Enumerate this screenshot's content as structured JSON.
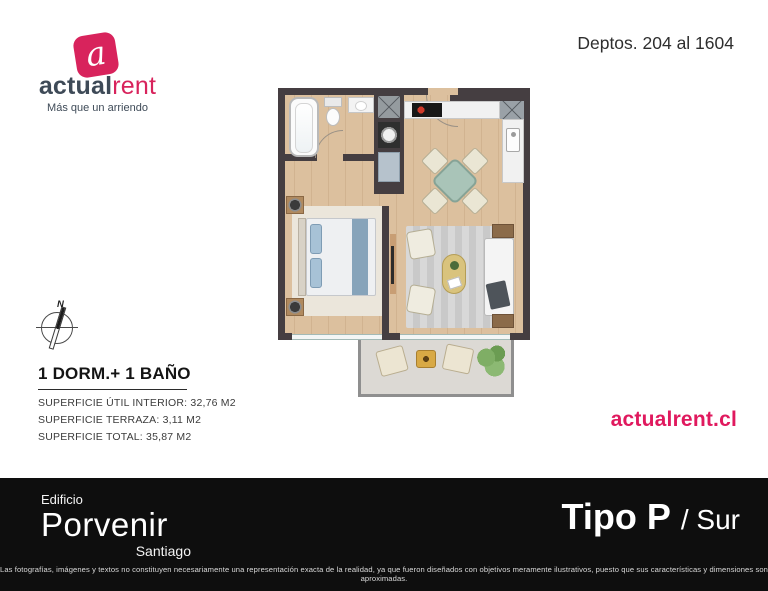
{
  "brand": {
    "logo_letter": "a",
    "name_primary": "actual",
    "name_secondary": "rent",
    "tagline": "Más que un arriendo",
    "website": "actualrent.cl",
    "accent_color": "#d8235c",
    "navy_color": "#3e4a57"
  },
  "header": {
    "depts_range": "Deptos. 204 al 1604"
  },
  "unit": {
    "compass_label": "N",
    "title": "1 DORM.+ 1 BAÑO",
    "areas": [
      "SUPERFICIE ÚTIL INTERIOR: 32,76 M2",
      "SUPERFICIE TERRAZA: 3,11 M2",
      "SUPERFICIE TOTAL: 35,87 M2"
    ]
  },
  "footer": {
    "building_label": "Edificio",
    "building_name": "Porvenir",
    "building_city": "Santiago",
    "unit_type_bold": "Tipo P",
    "unit_type_light": "/ Sur",
    "disclaimer": "Las fotografías, imágenes y textos no constituyen necesariamente una representación exacta de la realidad, ya que fueron diseñados con objetivos meramente ilustrativos, puesto que sus características y dimensiones son aproximadas.",
    "background_color": "#0e0e0e"
  }
}
